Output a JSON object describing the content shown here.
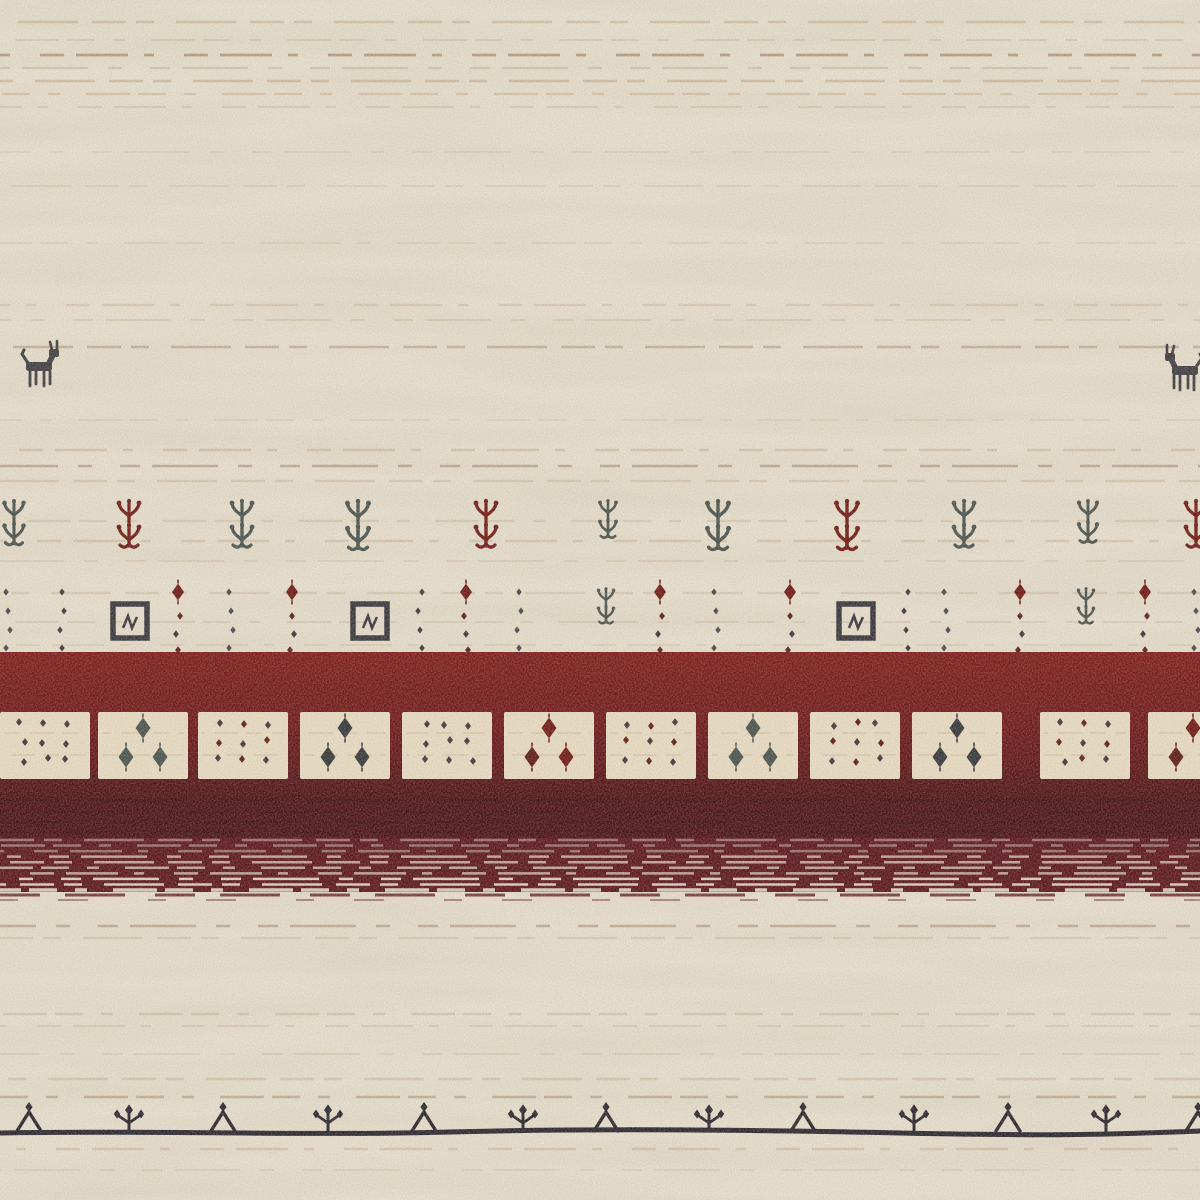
{
  "scene": {
    "description": "Close-up photo of a cream hand-knotted wool rug (Gabbeh style) with tribal motifs: two small animal figures, a row of plant motifs, dotted columns, a dark red band containing a row of cream squares with dot and diamond motifs, a striated maroon band, and a bottom black border line with alternating triangle and plant motifs.",
    "width": 1200,
    "height": 1200
  },
  "palette": {
    "cream": "#e9e1d0",
    "cream_square": "#eaddc4",
    "tan": "#b79b79",
    "tan_dark": "#8a6747",
    "red_top": "#7c1616",
    "red_mid": "#6f1313",
    "red_deep": "#5f1013",
    "red_darkest": "#470c10",
    "maroon_band": "#571017",
    "line_black": "#23202a",
    "motif_black": "#33323a",
    "motif_dark": "#3a3136",
    "motif_gray": "#454f4b",
    "motif_red": "#6d130e",
    "motif_maroon": "#5a150f",
    "animal_color": "#3b393f"
  },
  "texture": {
    "dashes": [
      "34 10 18 22 60 14",
      "12 26 44 8 28 18",
      "52 16 10 30 24 12",
      "20 12 66 20 14 28"
    ]
  },
  "striations": [
    {
      "y": 22,
      "w": 2.4,
      "o": 0.45,
      "p": 0
    },
    {
      "y": 40,
      "w": 2,
      "o": 0.28,
      "p": 1
    },
    {
      "y": 55,
      "w": 2.8,
      "o": 0.55,
      "p": 2,
      "dk": 1
    },
    {
      "y": 68,
      "w": 2.2,
      "o": 0.4,
      "p": 3
    },
    {
      "y": 81,
      "w": 2.6,
      "o": 0.5,
      "p": 0
    },
    {
      "y": 94,
      "w": 2.2,
      "o": 0.42,
      "p": 1
    },
    {
      "y": 107,
      "w": 2,
      "o": 0.3,
      "p": 2
    },
    {
      "y": 152,
      "w": 2,
      "o": 0.18,
      "p": 3
    },
    {
      "y": 186,
      "w": 2,
      "o": 0.22,
      "p": 0
    },
    {
      "y": 243,
      "w": 2,
      "o": 0.18,
      "p": 1
    },
    {
      "y": 305,
      "w": 2.2,
      "o": 0.32,
      "p": 2
    },
    {
      "y": 320,
      "w": 2,
      "o": 0.26,
      "p": 3
    },
    {
      "y": 347,
      "w": 2.4,
      "o": 0.38,
      "p": 0,
      "dk": 1
    },
    {
      "y": 420,
      "w": 2,
      "o": 0.2,
      "p": 1
    },
    {
      "y": 450,
      "w": 2.4,
      "o": 0.4,
      "p": 2
    },
    {
      "y": 466,
      "w": 2.6,
      "o": 0.45,
      "p": 3,
      "dk": 1
    },
    {
      "y": 481,
      "w": 2.2,
      "o": 0.34,
      "p": 0
    },
    {
      "y": 521,
      "w": 2.2,
      "o": 0.3,
      "p": 1
    },
    {
      "y": 541,
      "w": 2.4,
      "o": 0.36,
      "p": 2
    },
    {
      "y": 561,
      "w": 2,
      "o": 0.24,
      "p": 3
    },
    {
      "y": 593,
      "w": 2.2,
      "o": 0.3,
      "p": 0
    },
    {
      "y": 622,
      "w": 2,
      "o": 0.26,
      "p": 1
    },
    {
      "y": 645,
      "w": 2,
      "o": 0.22,
      "p": 2
    },
    {
      "y": 926,
      "w": 2.6,
      "o": 0.42,
      "p": 3,
      "dk": 1
    },
    {
      "y": 938,
      "w": 2.2,
      "o": 0.3,
      "p": 0
    },
    {
      "y": 1014,
      "w": 2.4,
      "o": 0.36,
      "p": 1
    },
    {
      "y": 1026,
      "w": 2,
      "o": 0.28,
      "p": 2
    },
    {
      "y": 1054,
      "w": 2,
      "o": 0.22,
      "p": 3
    },
    {
      "y": 1079,
      "w": 2.4,
      "o": 0.36,
      "p": 0
    },
    {
      "y": 1097,
      "w": 2.6,
      "o": 0.4,
      "p": 1,
      "dk": 1
    },
    {
      "y": 1149,
      "w": 2.4,
      "o": 0.38,
      "p": 2
    },
    {
      "y": 1170,
      "w": 2,
      "o": 0.2,
      "p": 3
    }
  ],
  "red_zone": {
    "top": 652,
    "squares_y": 712,
    "squares_h": 67,
    "dark_top": 782,
    "striated_top": 838,
    "striated_bottom": 892,
    "striated_lines": 10
  },
  "band_squares": {
    "width": 90,
    "squares": [
      {
        "x": 0,
        "type": "dots",
        "c": "dark"
      },
      {
        "x": 98,
        "type": "diamonds",
        "c": "gray"
      },
      {
        "x": 198,
        "type": "dots",
        "c": "mix"
      },
      {
        "x": 300,
        "type": "diamonds",
        "c": "black"
      },
      {
        "x": 402,
        "type": "dots",
        "c": "dark"
      },
      {
        "x": 504,
        "type": "diamonds",
        "c": "red"
      },
      {
        "x": 606,
        "type": "dots",
        "c": "mix"
      },
      {
        "x": 708,
        "type": "diamonds",
        "c": "gray"
      },
      {
        "x": 810,
        "type": "dots",
        "c": "mix"
      },
      {
        "x": 912,
        "type": "diamonds",
        "c": "black"
      },
      {
        "x": 1040,
        "type": "dots",
        "c": "mix"
      },
      {
        "x": 1148,
        "type": "diamonds",
        "c": "red"
      }
    ]
  },
  "plant_row": {
    "y": 500,
    "items": [
      {
        "x": 14,
        "c": "g",
        "s": 0.95
      },
      {
        "x": 129,
        "c": "r",
        "s": 1
      },
      {
        "x": 242,
        "c": "g",
        "s": 1
      },
      {
        "x": 358,
        "c": "g",
        "s": 1.05
      },
      {
        "x": 486,
        "c": "r",
        "s": 1
      },
      {
        "x": 608,
        "c": "g",
        "s": 0.8
      },
      {
        "x": 718,
        "c": "g",
        "s": 1.05
      },
      {
        "x": 847,
        "c": "r",
        "s": 1.05
      },
      {
        "x": 964,
        "c": "g",
        "s": 1
      },
      {
        "x": 1088,
        "c": "g",
        "s": 0.9
      },
      {
        "x": 1196,
        "c": "r",
        "s": 1
      }
    ]
  },
  "dots_row": {
    "top": 582,
    "columns": [
      {
        "x": 8,
        "c": "gray"
      },
      {
        "x": 62,
        "c": "dark"
      },
      {
        "x": 178,
        "c": "red"
      },
      {
        "x": 231,
        "c": "gray"
      },
      {
        "x": 292,
        "c": "red"
      },
      {
        "x": 420,
        "c": "dark"
      },
      {
        "x": 466,
        "c": "red"
      },
      {
        "x": 519,
        "c": "gray"
      },
      {
        "x": 660,
        "c": "red"
      },
      {
        "x": 716,
        "c": "gray"
      },
      {
        "x": 790,
        "c": "red"
      },
      {
        "x": 906,
        "c": "dark"
      },
      {
        "x": 946,
        "c": "gray"
      },
      {
        "x": 1020,
        "c": "red"
      },
      {
        "x": 1145,
        "c": "red"
      },
      {
        "x": 1196,
        "c": "gray"
      }
    ],
    "square_motifs": [
      130,
      370,
      856
    ],
    "small_plants": [
      {
        "x": 606
      },
      {
        "x": 1086
      }
    ]
  },
  "animals": [
    {
      "x": 18,
      "y": 344,
      "flip": false
    },
    {
      "x": 1206,
      "y": 348,
      "flip": true
    }
  ],
  "border": {
    "line_y": 1132,
    "motifs": [
      {
        "x": 29,
        "t": "tri"
      },
      {
        "x": 129,
        "t": "pl"
      },
      {
        "x": 223,
        "t": "tri"
      },
      {
        "x": 328,
        "t": "pl"
      },
      {
        "x": 424,
        "t": "tri"
      },
      {
        "x": 523,
        "t": "pl"
      },
      {
        "x": 606,
        "t": "tri"
      },
      {
        "x": 709,
        "t": "pl"
      },
      {
        "x": 803,
        "t": "tri"
      },
      {
        "x": 914,
        "t": "pl"
      },
      {
        "x": 1008,
        "t": "tri"
      },
      {
        "x": 1106,
        "t": "pl"
      },
      {
        "x": 1198,
        "t": "tri"
      }
    ]
  }
}
